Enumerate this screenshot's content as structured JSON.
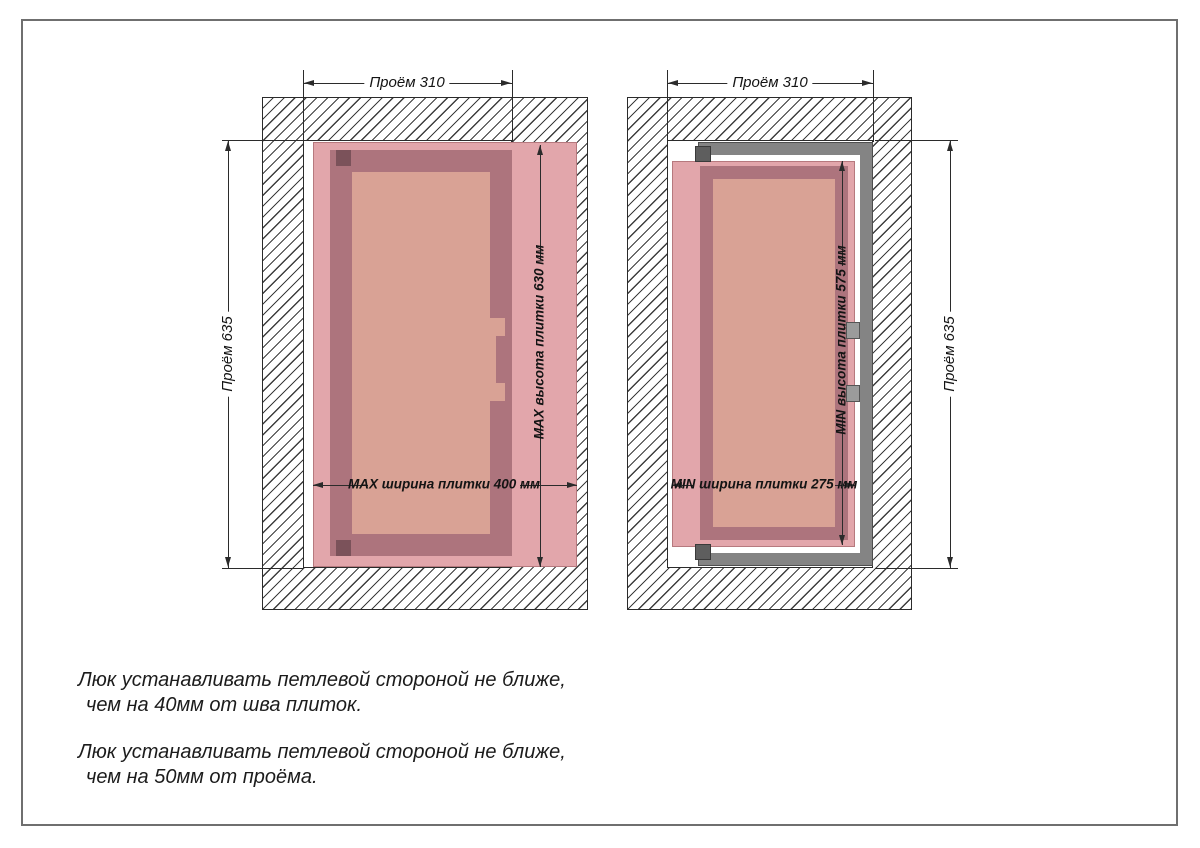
{
  "diagrams": {
    "left": {
      "dim_opening_width": "Проём 310",
      "dim_opening_height": "Проём 635",
      "dim_tile_width": "MAX ширина плитки 400 мм",
      "dim_tile_height": "MAX высота плитки 630 мм"
    },
    "right": {
      "dim_opening_width": "Проём 310",
      "dim_opening_height": "Проём 635",
      "dim_tile_width": "MIN ширина плитки 275 мм",
      "dim_tile_height": "MIN высота плитки 575 мм"
    }
  },
  "notes": [
    {
      "line1": "Люк устанавливать петлевой стороной не ближе,",
      "line2": "чем на 40мм от шва плиток."
    },
    {
      "line1": "Люк устанавливать петлевой стороной не ближе,",
      "line2": "чем на 50мм от проёма."
    }
  ],
  "colors": {
    "tile-pink": "#e2a6ab",
    "frame-mauve": "#ad747d",
    "door-salmon": "#d9a295",
    "metal-gray": "#848484",
    "hinge-dark": "#5e5e5e",
    "hinge-mauve": "#7b525a",
    "hatch-line": "#3d3d3d",
    "dim-line": "#2b2b2b",
    "page-border": "#6f6f6f"
  }
}
